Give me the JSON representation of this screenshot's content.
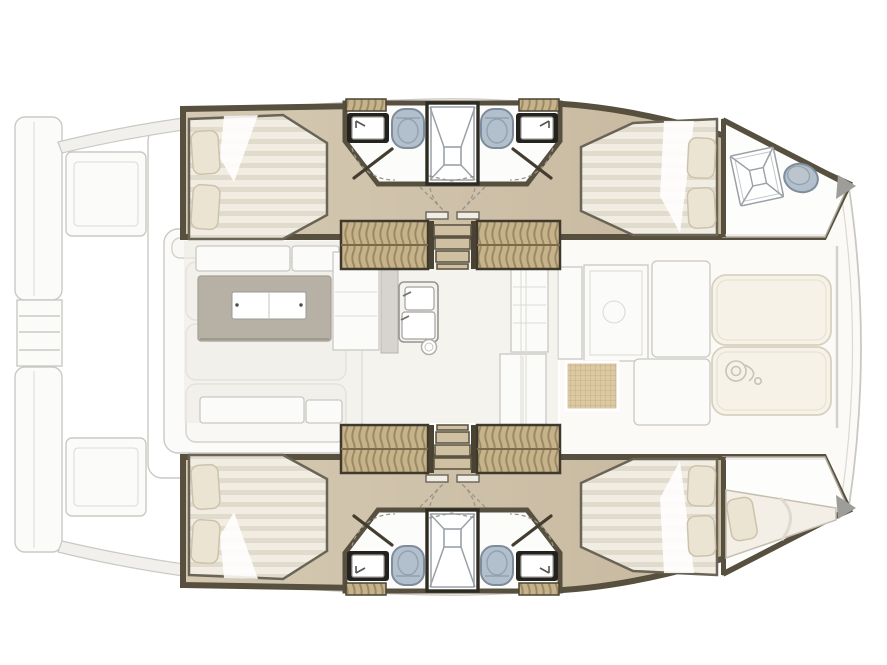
{
  "title": "Catamaran yacht floor plan — top view",
  "palette": {
    "bg": "#ffffff",
    "ghost": "#cbc9c4",
    "ghostFill": "#fbfbf9",
    "deck": "#f1f0ec",
    "wall": "#57503f",
    "wallDark": "#3f392d",
    "floor": "#c4b59b",
    "floorLight": "#d5c9b2",
    "room": "#fcfcfb",
    "mattress": "#f1ede3",
    "mattressStripe": "#e1dbce",
    "pillow": "#ece4d2",
    "pillowEdge": "#cdc3ac",
    "woodLocker": "#c6b38c",
    "lockerStripe": "#9b8a61",
    "step": "#cfc0a2",
    "wcBody": "#b2bfcc",
    "wcEdge": "#7e8c9b",
    "fixtureLine": "#9aa1a7",
    "sinkFrame": "#24221e",
    "salonFloor": "#eeebe4",
    "tableTop": "#b7b0a5",
    "tableLeaf": "#ffffff",
    "pad": "#f6f2e7",
    "padEdge": "#d7d1bf",
    "rattan": "#dcc9a3",
    "rattanLine": "#c0a87c",
    "tip": "#9e9d99"
  },
  "hulls": {
    "upper": {
      "rooms": [
        "aft-double-cabin",
        "aft-bathroom",
        "central-shower",
        "forward-bathroom",
        "forward-double-cabin",
        "bow-locker"
      ],
      "fixtures": [
        "double-bed",
        "pillows",
        "wash-basin",
        "toilet",
        "shower-door",
        "wardrobe",
        "companionway-steps",
        "deck-hatch",
        "bow-pod"
      ]
    },
    "lower": {
      "rooms": [
        "aft-double-cabin",
        "aft-bathroom",
        "central-shower",
        "forward-bathroom",
        "forward-double-cabin",
        "bow-berth"
      ],
      "fixtures": [
        "double-bed",
        "pillows",
        "wash-basin",
        "toilet",
        "shower-door",
        "wardrobe",
        "companionway-steps",
        "single-berth"
      ]
    }
  },
  "salon": {
    "fixtures": [
      "dining-table",
      "table-leaf",
      "bench-seats",
      "galley-counter",
      "galley-double-sink",
      "round-basin",
      "appliance-column",
      "mast-post"
    ]
  },
  "foredeck": {
    "fixtures": [
      "sun-pad",
      "sun-pad",
      "windlass",
      "rattan-table",
      "lounge-panels",
      "forward-crossbeam",
      "bow-bridle"
    ]
  },
  "stern": {
    "fixtures": [
      "swim-platform",
      "swim-platform",
      "transom-steps",
      "cockpit-coaming",
      "cockpit-bench",
      "bench-cushions",
      "stern-lockers"
    ]
  }
}
